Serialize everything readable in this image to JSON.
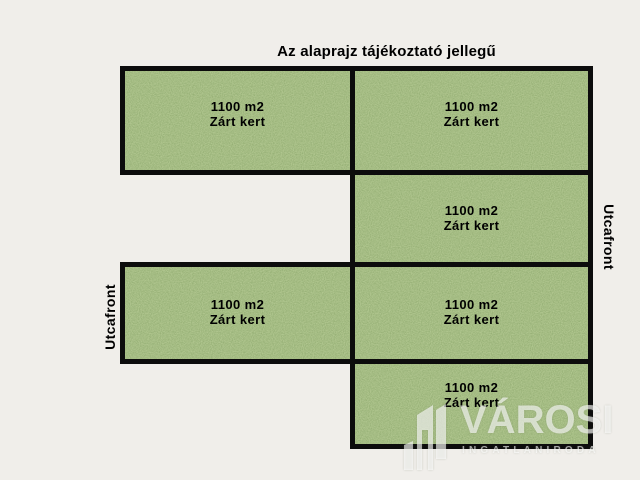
{
  "title": "Az alaprajz tájékoztató jellegű",
  "plots": [
    {
      "position": "top-left",
      "area": "1100 m2",
      "kind": "Zárt kert"
    },
    {
      "position": "top-right",
      "area": "1100 m2",
      "kind": "Zárt kert"
    },
    {
      "position": "middle-right",
      "area": "1100 m2",
      "kind": "Zárt kert"
    },
    {
      "position": "middle-left",
      "area": "1100 m2",
      "kind": "Zárt kert"
    },
    {
      "position": "middle-right-2",
      "area": "1100 m2",
      "kind": "Zárt kert"
    },
    {
      "position": "bottom-right",
      "area": "1100 m2",
      "kind": "Zárt kert"
    }
  ],
  "street_labels": {
    "left": "Utcafront",
    "right": "Utcafront"
  },
  "watermark": {
    "brand": "VÁROSI",
    "tagline": "INGATLANIRODA",
    "icon": "building-icon"
  },
  "colors": {
    "background": "#f0eeea",
    "grass": "#5a7c3e",
    "plot_border": "#0c0c0c",
    "text": "#000000",
    "watermark": "#ffffff"
  }
}
